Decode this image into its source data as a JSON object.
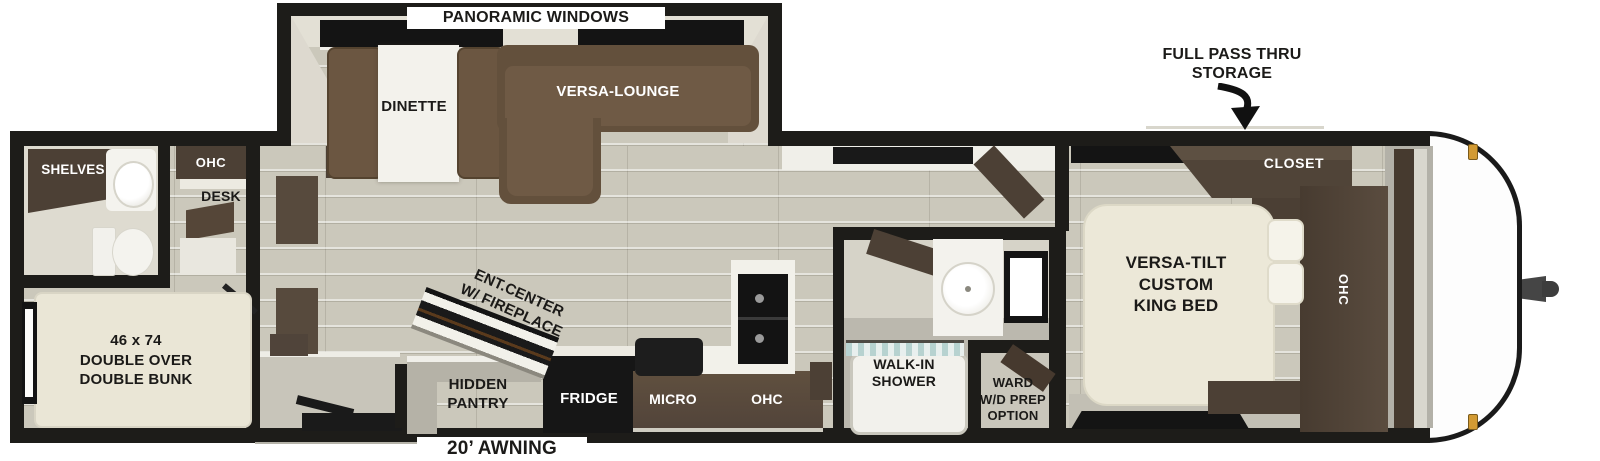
{
  "labels": {
    "panoramic_windows": "PANORAMIC WINDOWS",
    "full_pass_thru_storage": "FULL PASS THRU\nSTORAGE",
    "dinette": "DINETTE",
    "versa_lounge": "VERSA-LOUNGE",
    "shelves": "SHELVES",
    "desk_ohc": "OHC",
    "desk": "DESK",
    "double_bunk": "46 x 74\nDOUBLE OVER\nDOUBLE BUNK",
    "ent_center": "ENT.CENTER\nW/ FIREPLACE",
    "hidden_pantry": "HIDDEN\nPANTRY",
    "fridge": "FRIDGE",
    "micro": "MICRO",
    "kitchen_ohc": "OHC",
    "walk_in_shower": "WALK-IN\nSHOWER",
    "ward_wd_prep": "WARD\nW/D PREP\nOPTION",
    "closet": "CLOSET",
    "king_bed": "VERSA-TILT\nCUSTOM\nKING BED",
    "bedroom_ohc": "OHC",
    "awning": "20’ AWNING"
  },
  "colors": {
    "wall_black": "#1d1c19",
    "floor_plank": "#cbc8bb",
    "wall_face_beige": "#dedbd0",
    "cabinet_dark_brown": "#4c4035",
    "sofa_brown": "#6b5641",
    "counter_brown": "#5a4a3c",
    "bed_cream": "#ece8d8",
    "appliance_black": "#161616",
    "shower_glass_teal": "#b7d2d0",
    "marker_light_amber": "#d29a33",
    "gray_floor": "#bdbab0"
  }
}
